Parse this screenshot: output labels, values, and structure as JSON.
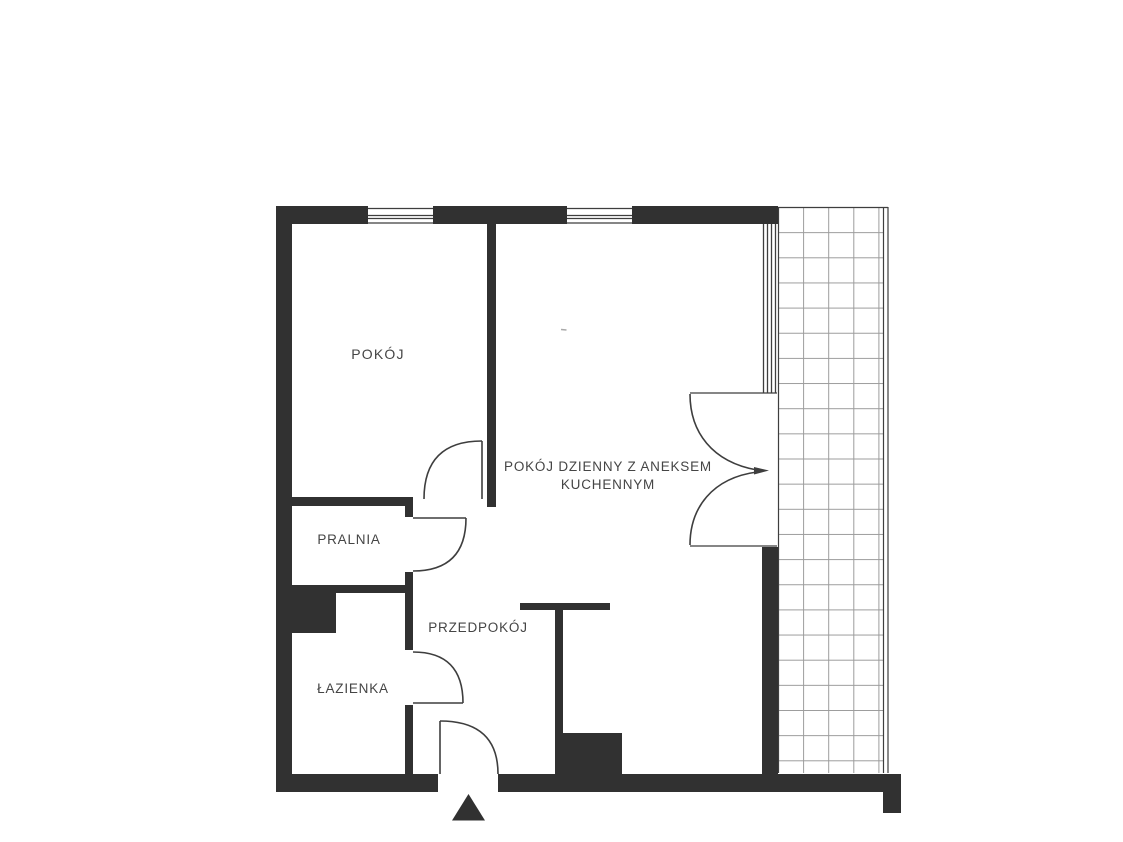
{
  "plan": {
    "type_label": "apartment-floor-plan",
    "rooms": {
      "pokoj": {
        "label": "POKÓJ"
      },
      "living": {
        "label_line1": "POKÓJ DZIENNY Z ANEKSEM",
        "label_line2": "KUCHENNYM"
      },
      "pralnia": {
        "label": "PRALNIA"
      },
      "przedpokoj": {
        "label": "PRZEDPOKÓJ"
      },
      "lazienka": {
        "label": "ŁAZIENKA"
      }
    },
    "markers": {
      "entrance_icon": "entrance-triangle"
    }
  },
  "colors": {
    "wall": "#313131",
    "line": "#3e3e3e",
    "grid": "#9c9c9c",
    "artifact": "#a9a9a9",
    "text": "#454545",
    "background": "#ffffff"
  }
}
